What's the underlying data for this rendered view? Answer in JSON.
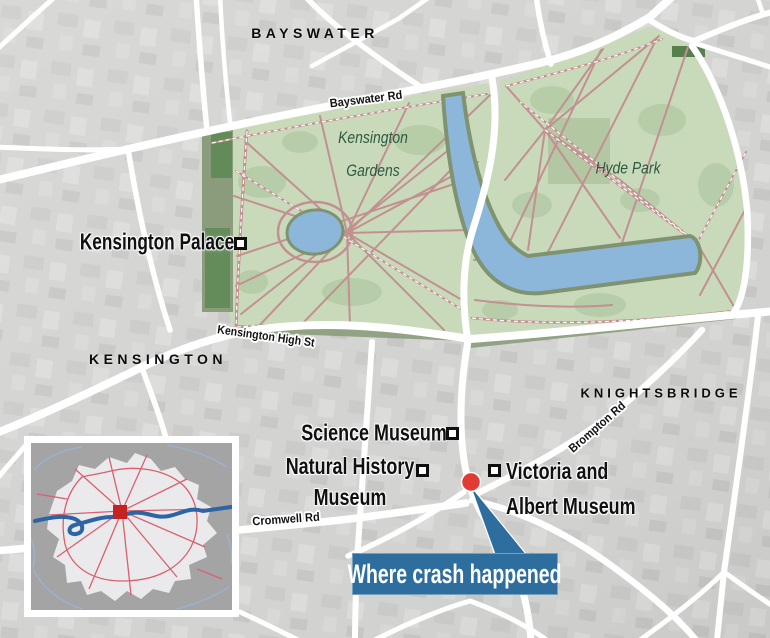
{
  "labels": {
    "bayswater": "BAYSWATER",
    "kensington": "KENSINGTON",
    "knightsbridge": "KNIGHTSBRIDGE",
    "kensington_gardens_line1": "Kensington",
    "kensington_gardens_line2": "Gardens",
    "hyde_park": "Hyde Park",
    "bayswater_rd": "Bayswater Rd",
    "kensington_high_st": "Kensington High St",
    "cromwell_rd": "Cromwell Rd",
    "brompton_rd": "Brompton Rd",
    "kensington_palace": "Kensington Palace",
    "science_museum": "Science Museum",
    "natural_history_line1": "Natural History",
    "natural_history_line2": "Museum",
    "victoria_albert_line1": "Victoria and",
    "victoria_albert_line2": "Albert Museum"
  },
  "callout": {
    "label": "Where crash happened",
    "bg_color": "#2e6e9e",
    "text_color": "#ffffff"
  },
  "markers": {
    "crash_dot_color": "#e23a34",
    "poi_square_fill": "#ffffff",
    "poi_square_border": "#0f0f0f",
    "inset_square_color": "#c62222"
  },
  "map_colors": {
    "background_gray": "#d3d3d1",
    "road_white": "#ffffff",
    "park_green": "#c9dabb",
    "park_path_pink": "#c29090",
    "water_blue": "#8cb6da",
    "dark_green": "#8b9c7d",
    "park_label_green": "#2d5a40",
    "inset_background": "#a4a4a4",
    "inset_land": "#eaeaec",
    "inset_road_red": "#d95f6f",
    "inset_thames_blue": "#2c64a4"
  }
}
